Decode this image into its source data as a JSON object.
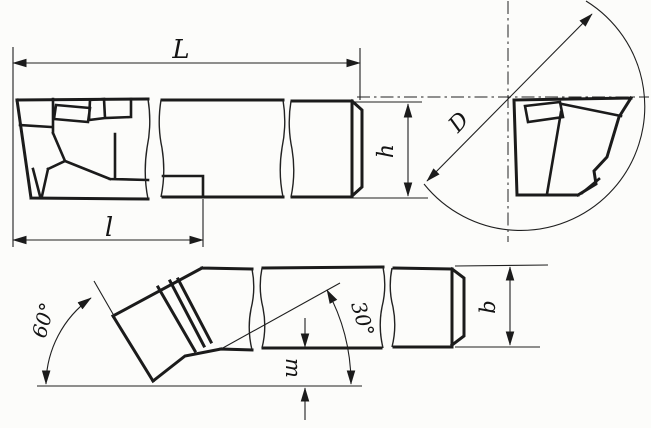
{
  "diagram": {
    "kind": "technical-drawing-cutting-tool",
    "labels": {
      "overall_length": "L",
      "head_length": "l",
      "shank_height": "h",
      "diameter": "D",
      "shank_width": "b",
      "tip_offset": "m",
      "angle_main": "60°",
      "angle_secondary": "30°"
    },
    "colors": {
      "line": "#1b1b1b",
      "background": "#fcfcfa"
    }
  }
}
